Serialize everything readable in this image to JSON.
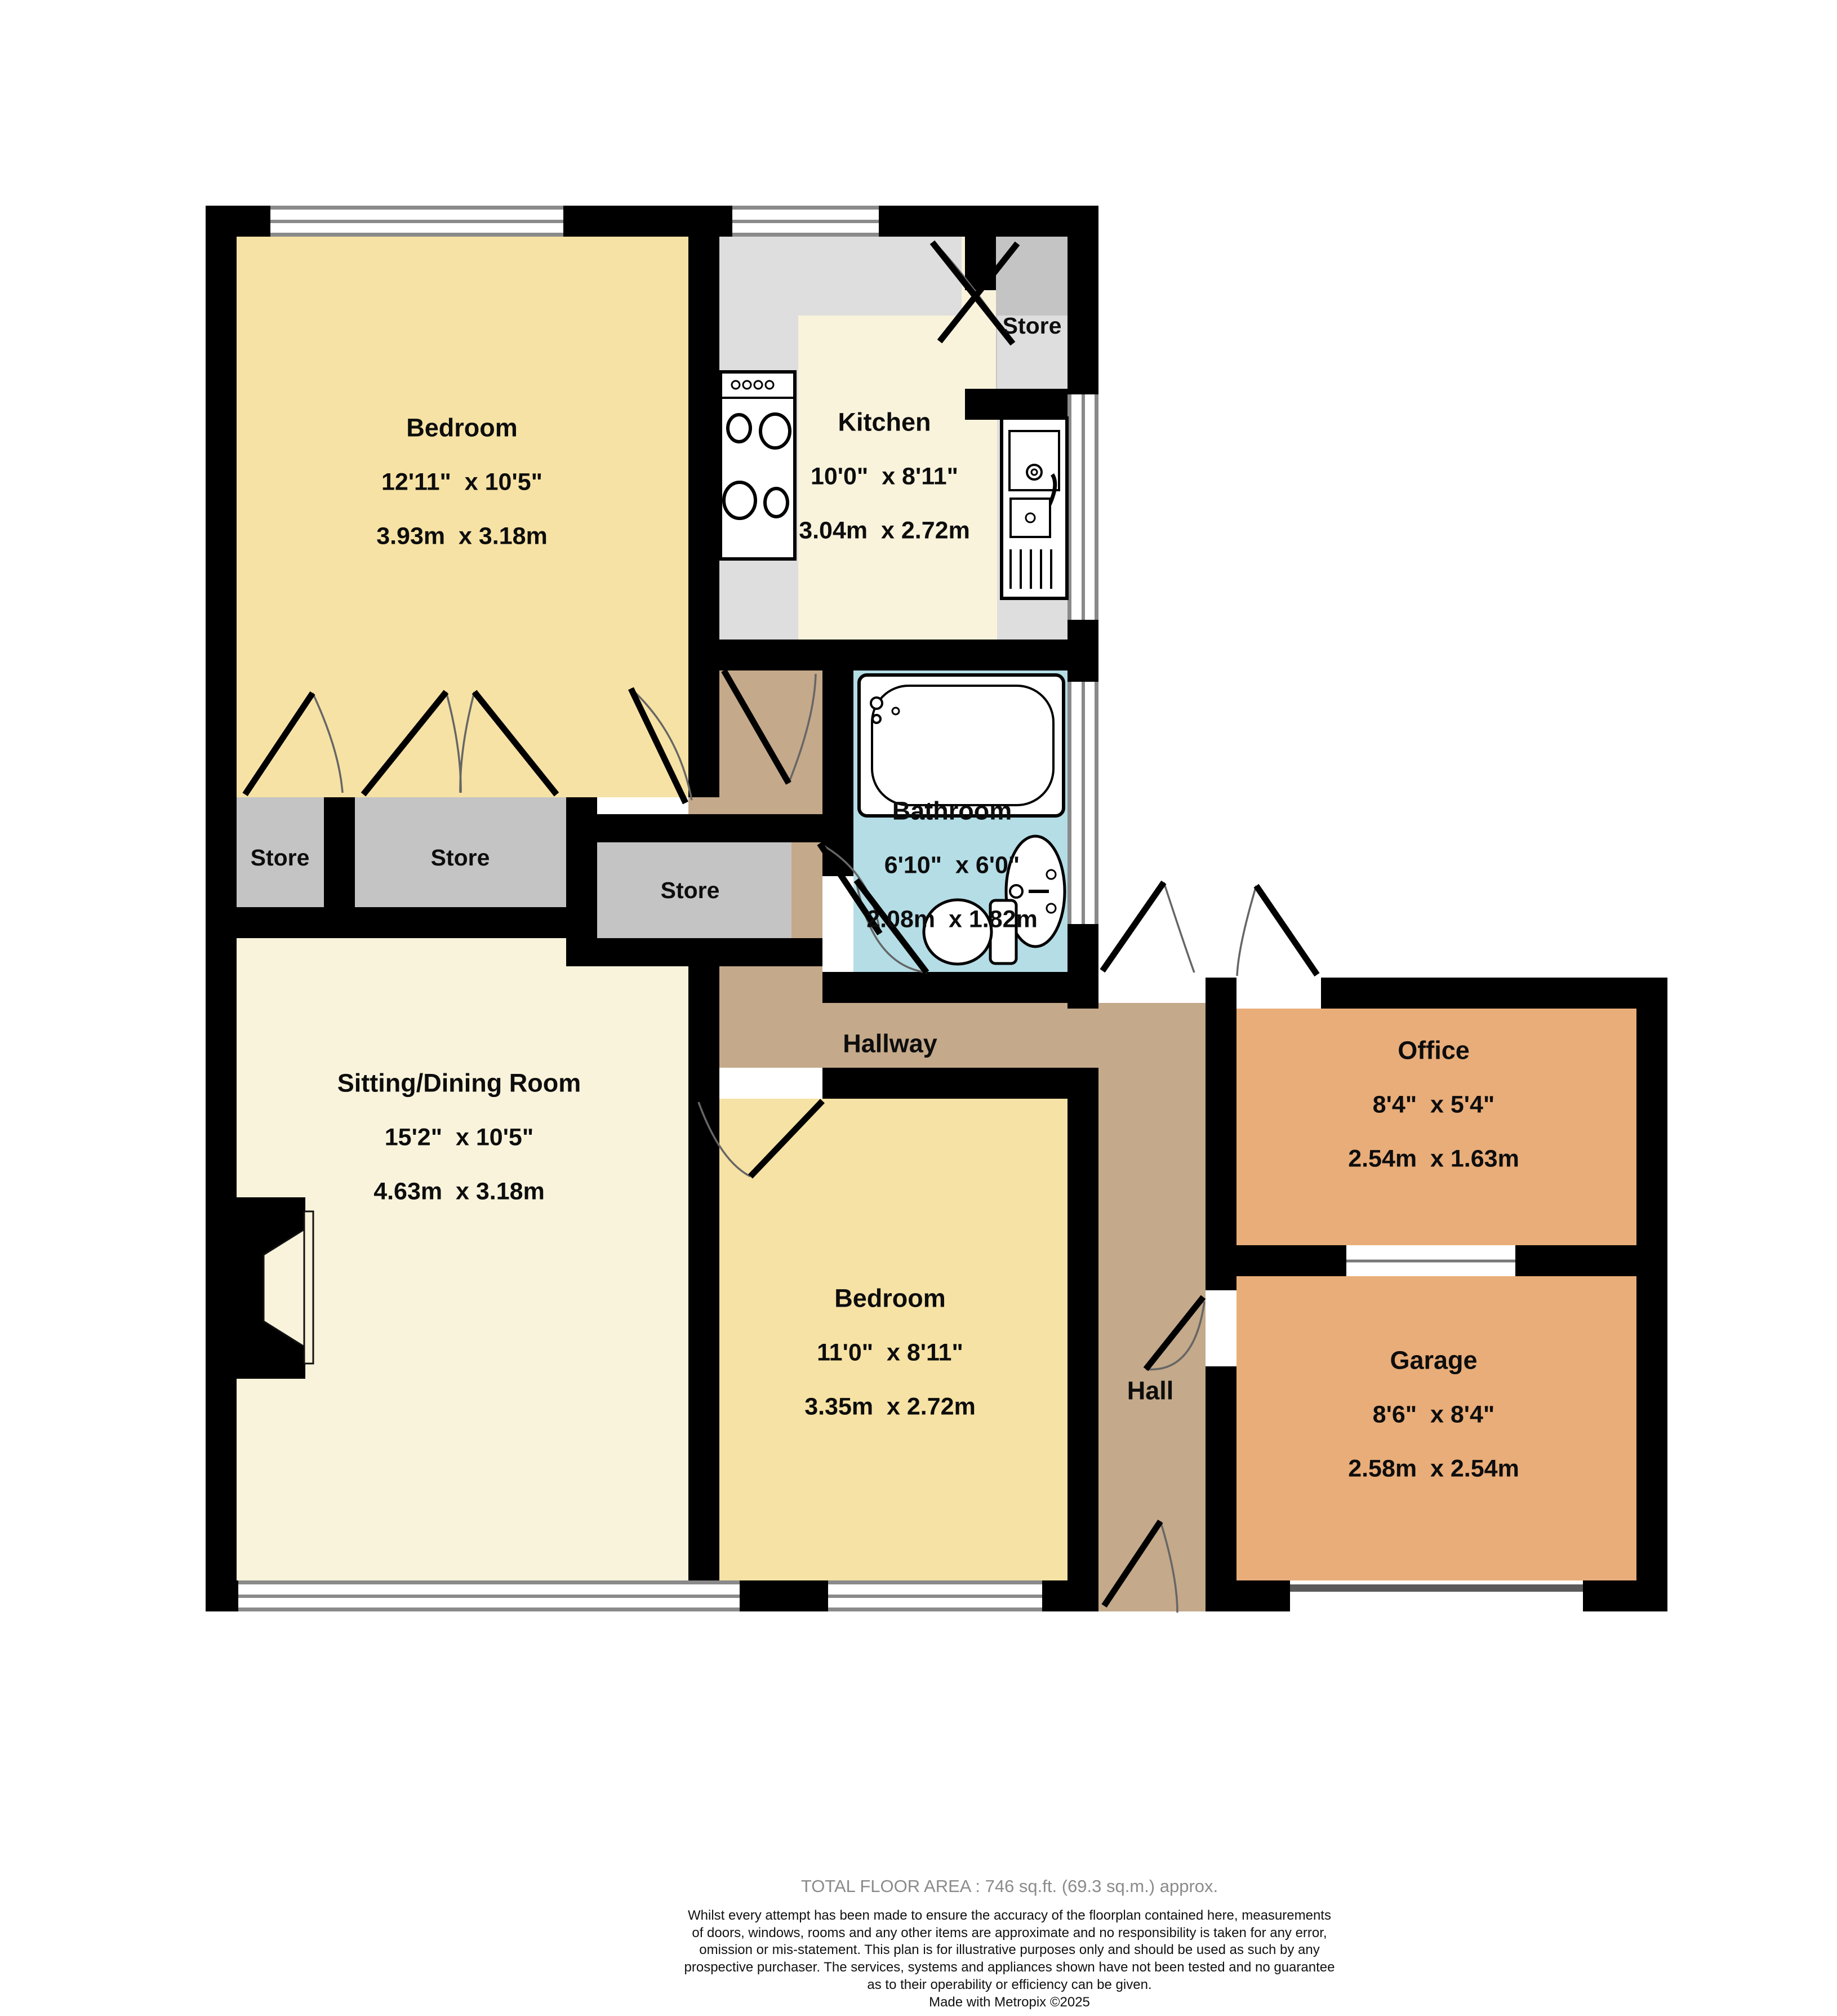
{
  "plan": {
    "rooms": {
      "bedroom1": {
        "name": "Bedroom",
        "imperial": "12'11\"  x 10'5\"",
        "metric": "3.93m  x 3.18m"
      },
      "kitchen": {
        "name": "Kitchen",
        "imperial": "10'0\"  x 8'11\"",
        "metric": "3.04m  x 2.72m"
      },
      "bathroom": {
        "name": "Bathroom",
        "imperial": "6'10\"  x 6'0\"",
        "metric": "2.08m  x 1.82m"
      },
      "sitting": {
        "name": "Sitting/Dining Room",
        "imperial": "15'2\"  x 10'5\"",
        "metric": "4.63m  x 3.18m"
      },
      "bedroom2": {
        "name": "Bedroom",
        "imperial": "11'0\"  x 8'11\"",
        "metric": "3.35m  x 2.72m"
      },
      "office": {
        "name": "Office",
        "imperial": "8'4\"  x 5'4\"",
        "metric": "2.54m  x 1.63m"
      },
      "garage": {
        "name": "Garage",
        "imperial": "8'6\"  x 8'4\"",
        "metric": "2.58m  x 2.54m"
      },
      "hallway": {
        "name": "Hallway"
      },
      "hall": {
        "name": "Hall"
      },
      "store_top": {
        "name": "Store"
      },
      "store_1": {
        "name": "Store"
      },
      "store_2": {
        "name": "Store"
      },
      "store_3": {
        "name": "Store"
      }
    },
    "colors": {
      "wall": "#000000",
      "bedroom_fill": "#f6e2a4",
      "living_fill": "#f9f3dc",
      "store_fill": "#c4c4c4",
      "counter_fill": "#dedede",
      "bathroom_fill": "#b4dde6",
      "hallway_fill": "#c4a98a",
      "garage_fill": "#e9ad79",
      "window_frame": "#8a8a8a",
      "footer_gray": "#8b8b8b"
    }
  },
  "footer": {
    "total_area": "TOTAL FLOOR AREA : 746 sq.ft. (69.3 sq.m.) approx.",
    "disclaimer_lines": [
      "Whilst every attempt has been made to ensure the accuracy of the floorplan contained here, measurements",
      "of doors, windows, rooms and any other items are approximate and no responsibility is taken for any error,",
      "omission or mis-statement. This plan is for illustrative purposes only and should be used as such by any",
      "prospective purchaser. The services, systems and appliances shown have not been tested and no guarantee",
      "as to their operability or efficiency can be given."
    ],
    "made_with": "Made with Metropix ©2025"
  }
}
